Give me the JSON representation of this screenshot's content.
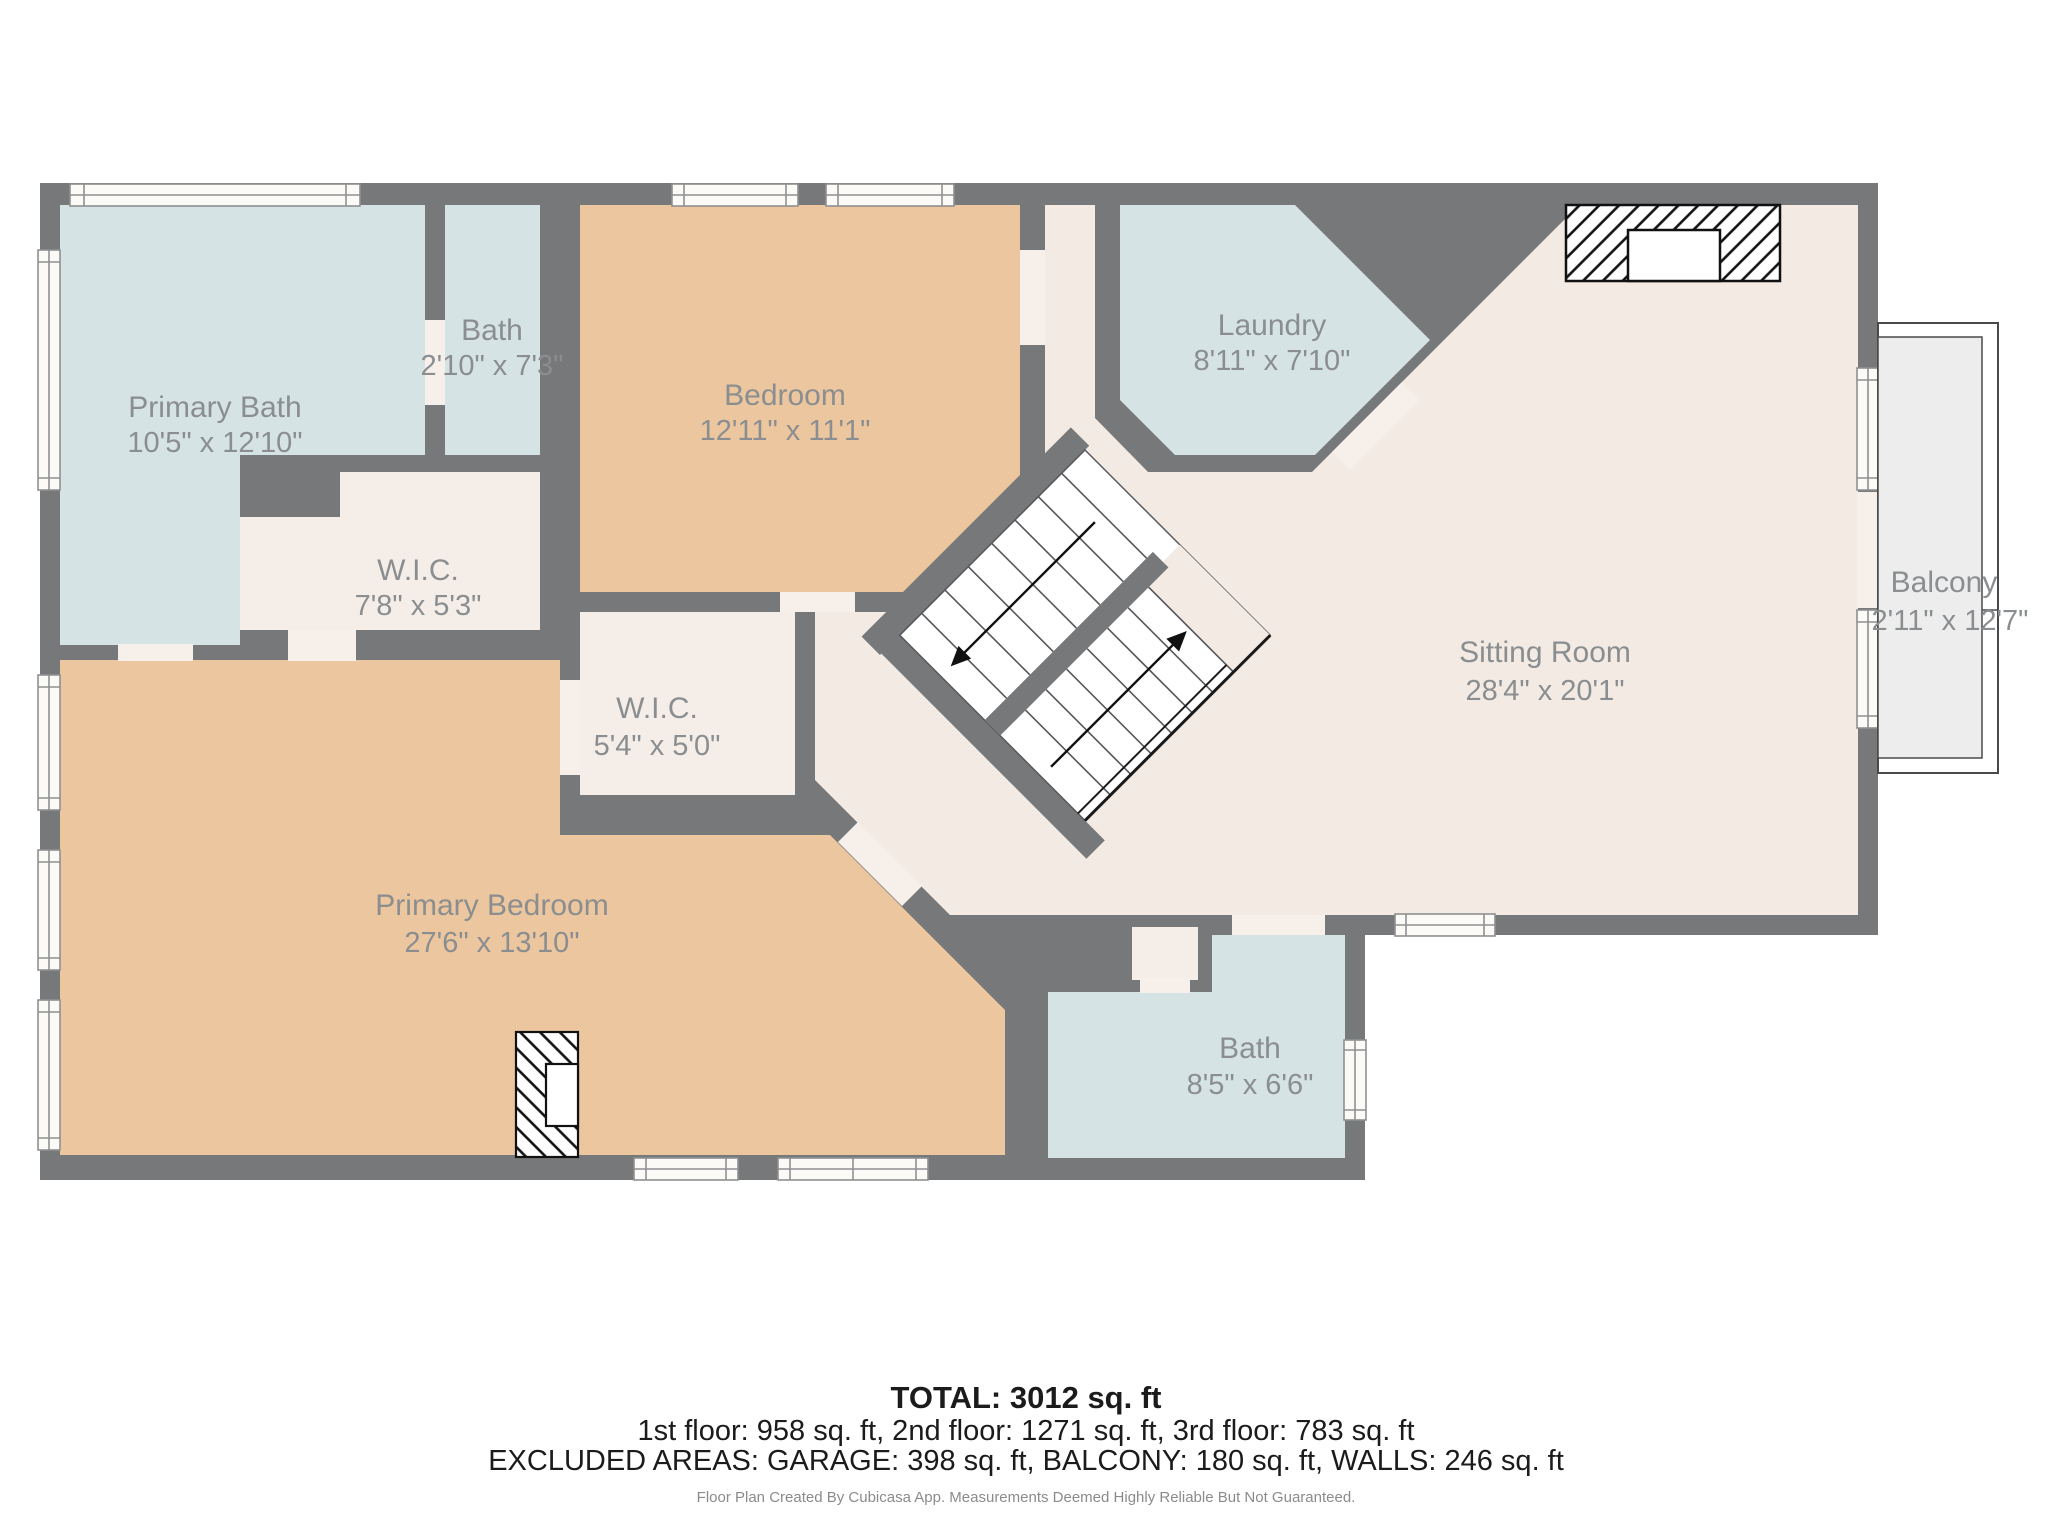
{
  "plan": {
    "rooms": {
      "primary_bath": {
        "name": "Primary Bath",
        "dims": "10'5\" x 12'10\""
      },
      "bath_small": {
        "name": "Bath",
        "dims": "2'10\" x 7'3\""
      },
      "bedroom": {
        "name": "Bedroom",
        "dims": "12'11\" x 11'1\""
      },
      "laundry": {
        "name": "Laundry",
        "dims": "8'11\" x 7'10\""
      },
      "wic_large": {
        "name": "W.I.C.",
        "dims": "7'8\" x 5'3\""
      },
      "wic_small": {
        "name": "W.I.C.",
        "dims": "5'4\" x 5'0\""
      },
      "sitting_room": {
        "name": "Sitting Room",
        "dims": "28'4\" x 20'1\""
      },
      "balcony": {
        "name": "Balcony",
        "dims": "2'11\" x 12'7\""
      },
      "primary_bedroom": {
        "name": "Primary Bedroom",
        "dims": "27'6\" x 13'10\""
      },
      "bath_lower": {
        "name": "Bath",
        "dims": "8'5\" x 6'6\""
      }
    },
    "footer": {
      "total": "TOTAL: 3012 sq. ft",
      "floors": "1st floor: 958 sq. ft, 2nd floor: 1271 sq. ft, 3rd floor: 783 sq. ft",
      "excluded": "EXCLUDED AREAS: GARAGE: 398 sq. ft, BALCONY: 180 sq. ft, WALLS: 246 sq. ft",
      "disclaimer": "Floor Plan Created By Cubicasa App. Measurements Deemed Highly Reliable But Not Guaranteed."
    },
    "colors": {
      "wall": "#76787a",
      "floor_cream": "#f2eae3",
      "floor_wic": "#f5eee8",
      "floor_tan": "#ecc69e",
      "floor_blue": "#d5e3e4",
      "door_gap": "#f7f0ea",
      "window_fill": "#fcfaf6",
      "window_frame": "#8f9092",
      "balcony_fill": "#ededed",
      "balcony_stroke": "#4a4a4a",
      "stairs_white": "#ffffff",
      "label_gray": "#8b8e90"
    }
  }
}
